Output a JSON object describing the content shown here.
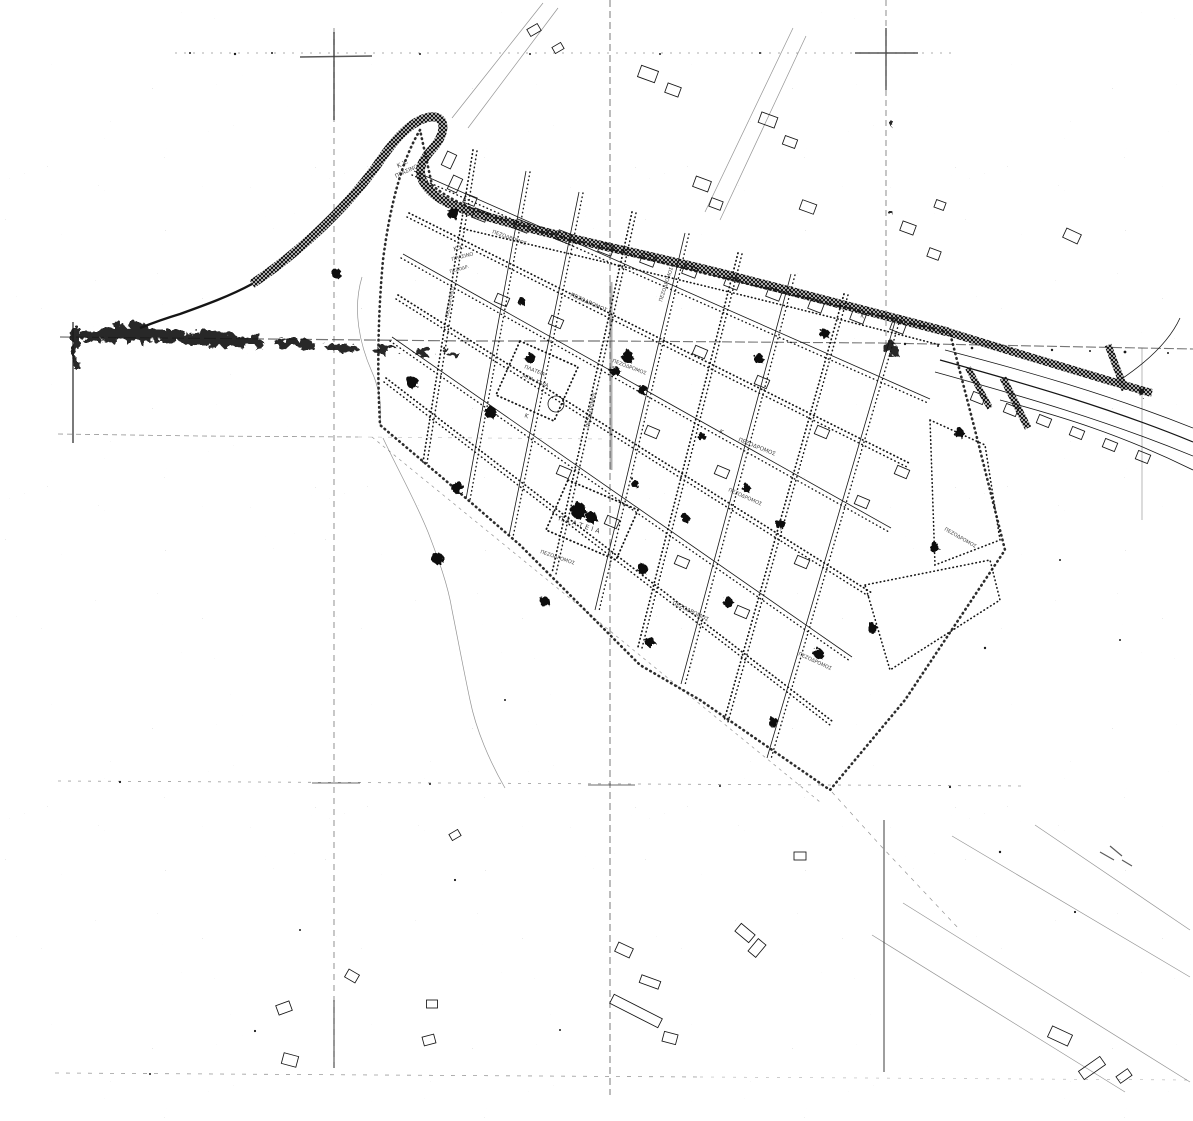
{
  "page": {
    "title": "Scanned town-plan map sheet (Greek)",
    "paper_color": "#ffffff",
    "ink_color": "#151515"
  },
  "map": {
    "labels": {
      "green_space_line1": "Κ.Χ.",
      "green_space_line2": "ΠΡΑΣΙΝΟ",
      "pedestrian_street": "ΠΕΖΟΔΡΟΜΟΣ",
      "pedestrian_abbrev": "ΠΕΖΟΔΡ.",
      "square1_line1": "ΠΛΑΤΕΙΑ",
      "square1_line2": "ΜΠΑ. ΚΑΡΑ",
      "square2": "ΠΛΑΤΕΙΑ",
      "block_mark": "Κ"
    }
  }
}
